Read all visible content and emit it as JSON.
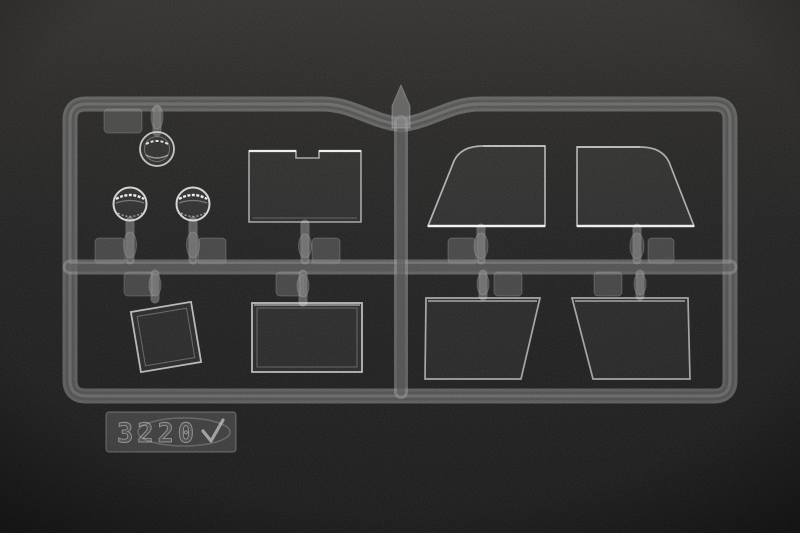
{
  "scene": {
    "description": "Photograph of a clear transparent injection-molded model kit sprue (parts tree) lying on a black fine-grained textured background, lit from above",
    "background_colors": {
      "top": "#2f2e2b",
      "middle": "#1d1d1d",
      "bottom": "#151515"
    },
    "sprue_tint": "#9a9a9a",
    "part_edge_highlight": "#e6e6e6"
  },
  "tag": {
    "kit_number": "3220",
    "mark": "checkmark",
    "logo": "oval-swirl-outline"
  },
  "parts": [
    {
      "name": "small-round-lens",
      "shape": "circle with concentric molded rings",
      "location": "top-left, hanging below top rail"
    },
    {
      "name": "round-lens-left",
      "shape": "circular clear lens with bright top band",
      "location": "upper-left quadrant, above middle rail"
    },
    {
      "name": "round-lens-right",
      "shape": "circular clear lens with bright top band",
      "location": "upper-left quadrant, above middle rail"
    },
    {
      "name": "notched-rectangular-window",
      "shape": "rectangle with notch cut in top edge",
      "location": "upper-left quadrant, left of center divider"
    },
    {
      "name": "curved-windscreen-left",
      "shape": "quarter-window, sloped left edge with rounded top corner",
      "location": "upper-right quadrant"
    },
    {
      "name": "curved-windscreen-right",
      "shape": "mirrored quarter-window, sloped right edge with rounded top corner",
      "location": "upper-right quadrant"
    },
    {
      "name": "tilted-square-window",
      "shape": "square pane with raised double border, rotated",
      "location": "lower-left quadrant, hanging below middle rail"
    },
    {
      "name": "rectangular-window",
      "shape": "rectangle pane with raised double border",
      "location": "lower-left quadrant, hanging below middle rail"
    },
    {
      "name": "trapezoid-window-left",
      "shape": "trapezoid pane, right edge slanted inward",
      "location": "lower-right quadrant"
    },
    {
      "name": "trapezoid-window-right",
      "shape": "mirrored trapezoid pane, left edge slanted inward",
      "location": "lower-right quadrant"
    },
    {
      "name": "kit-number-tag",
      "shape": "rectangular molded tag with kit number and oval logo",
      "location": "bottom-left, hanging below bottom rail"
    }
  ],
  "sprue_structure": {
    "frame": "rounded rectangle with dip and pointed gate at top center",
    "rails": [
      "top rail with central dip",
      "middle horizontal rail",
      "bottom rail",
      "left rail",
      "right rail",
      "central vertical divider"
    ],
    "attachment_tabs": "small rounded part-number tabs beside each attachment stem"
  }
}
